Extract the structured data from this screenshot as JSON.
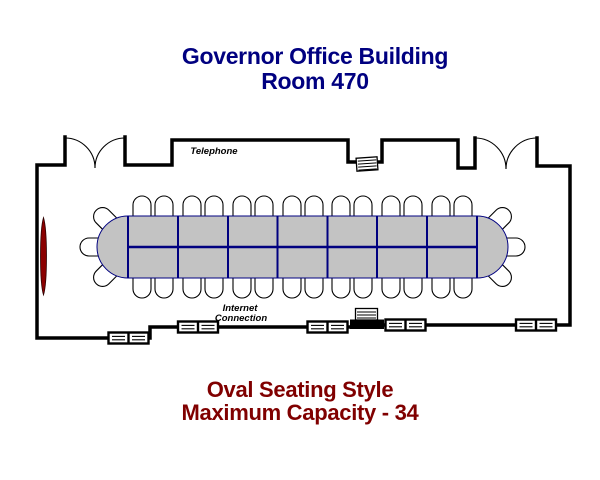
{
  "header": {
    "building": "Governor Office Building",
    "room": "Room 470"
  },
  "plan": {
    "labels": {
      "telephone": "Telephone",
      "internet_line1": "Internet",
      "internet_line2": "Connection"
    },
    "table": {
      "shape": "oval",
      "columns": 7,
      "rows": 2
    },
    "seats": {
      "top_row": 14,
      "bottom_row": 14,
      "left_end": 3,
      "right_end": 3,
      "total": 34
    },
    "fixtures": {
      "double_doors": 2,
      "outlet_boxes": 5,
      "telephone_jack": 1,
      "podium_equipment": 1,
      "wall_screen": 1
    },
    "colors": {
      "title": "#000080",
      "caption": "#800000",
      "wall": "#000000",
      "table_fill": "#c3c3c3",
      "table_grid": "#000080",
      "chair_fill": "#ffffff",
      "screen": "#8b0000"
    }
  },
  "caption": {
    "style_line": "Oval Seating Style",
    "capacity_line": "Maximum Capacity - 34"
  }
}
